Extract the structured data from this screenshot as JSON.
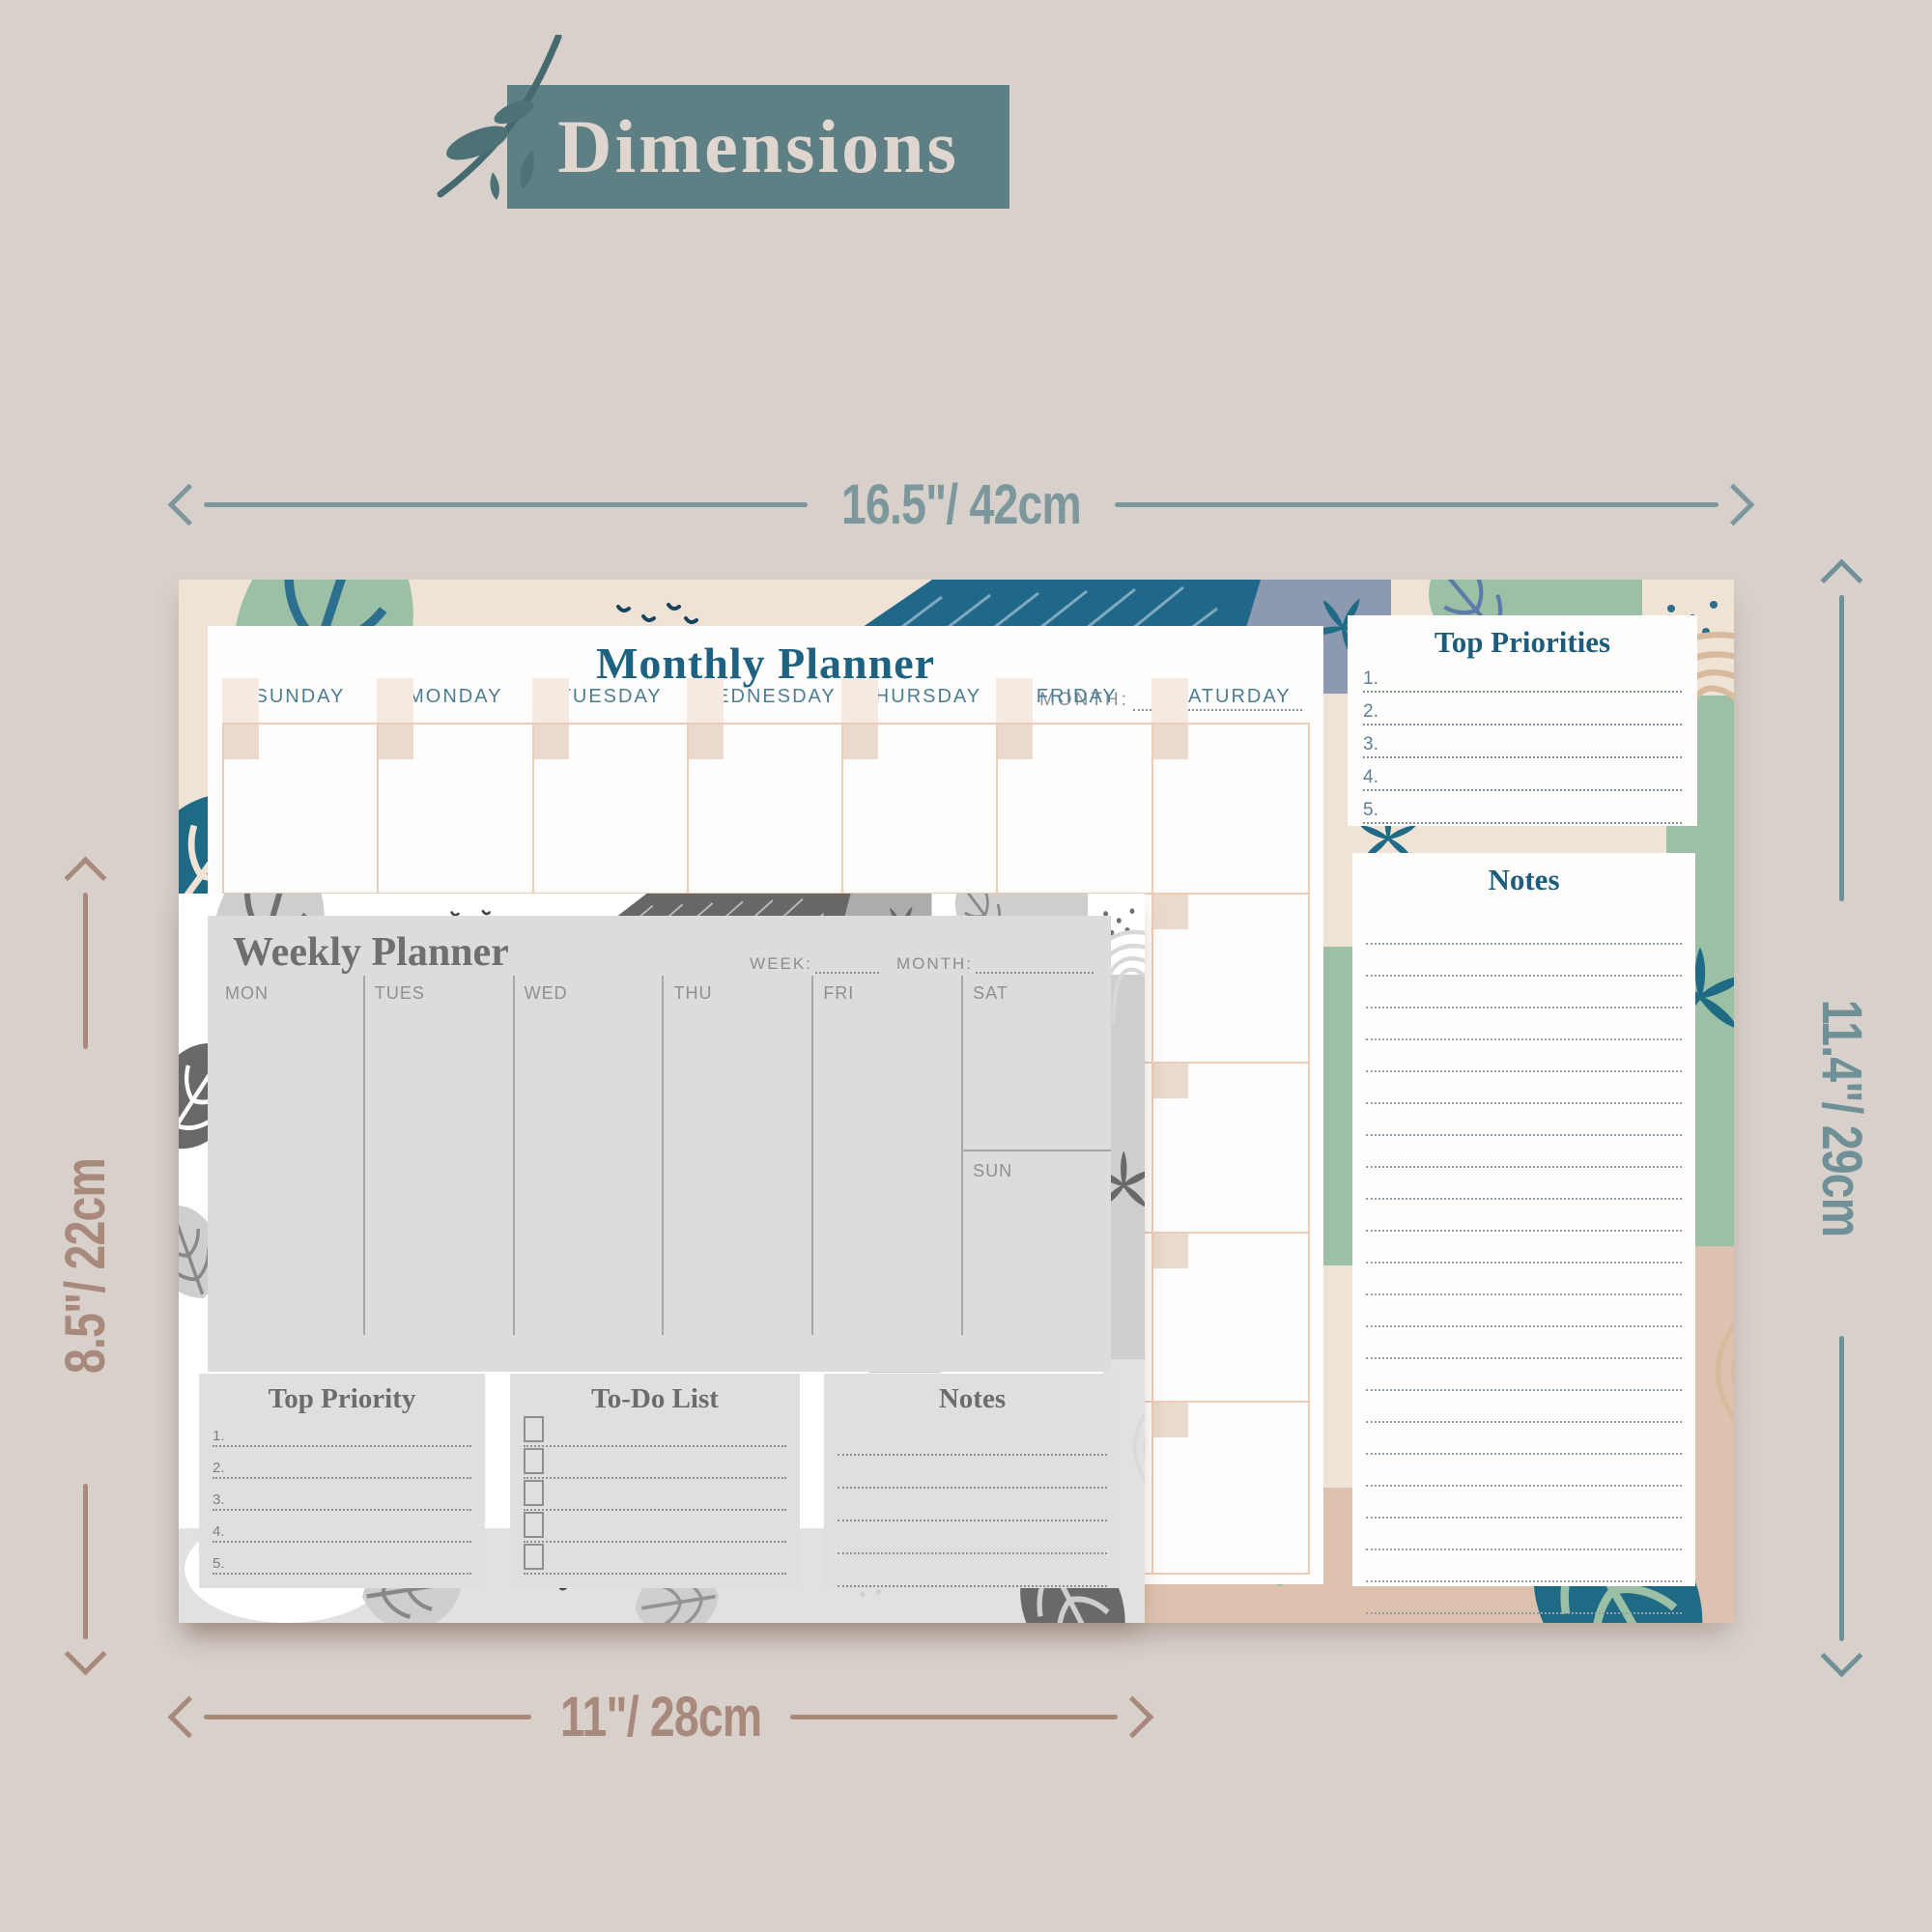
{
  "banner": {
    "title": "Dimensions"
  },
  "dimensions": {
    "width_top": "16.5\"/ 42cm",
    "height_right": "11.4\"/ 29cm",
    "height_left": "8.5\"/ 22cm",
    "width_bottom": "11\"/ 28cm"
  },
  "monthly_planner": {
    "title": "Monthly Planner",
    "month_label": "MONTH:",
    "days": [
      "SUNDAY",
      "MONDAY",
      "TUESDAY",
      "WEDNESDAY",
      "THURSDAY",
      "FRIDAY",
      "SATURDAY"
    ],
    "top_priorities": {
      "title": "Top Priorities",
      "items": [
        "1.",
        "2.",
        "3.",
        "4.",
        "5."
      ]
    },
    "notes_title": "Notes"
  },
  "weekly_planner": {
    "title": "Weekly Planner",
    "week_label": "WEEK:",
    "month_label": "MONTH:",
    "days": [
      "MON",
      "TUES",
      "WED",
      "THU",
      "FRI",
      "SAT",
      "SUN"
    ],
    "top_priority": {
      "title": "Top Priority",
      "items": [
        "1.",
        "2.",
        "3.",
        "4.",
        "5."
      ]
    },
    "todo_title": "To-Do List",
    "notes_title": "Notes"
  },
  "palette": {
    "background": "#d8d0cb",
    "banner_teal": "#5e7f83",
    "banner_text": "#ded6cf",
    "arrow_teal": "#7d989d",
    "arrow_teal_dark": "#6f9096",
    "arrow_brown": "#a8897c",
    "planner_accent_teal": "#1d6280",
    "grid_peach": "#eecdb8",
    "pattern_sage": "#9cc0a5",
    "pattern_teal": "#20688a",
    "pattern_tan": "#ddc3af",
    "pattern_cream": "#efe3d6",
    "pattern_bluegray": "#8c99b0",
    "weekly_gray": "#dcdcdd"
  }
}
